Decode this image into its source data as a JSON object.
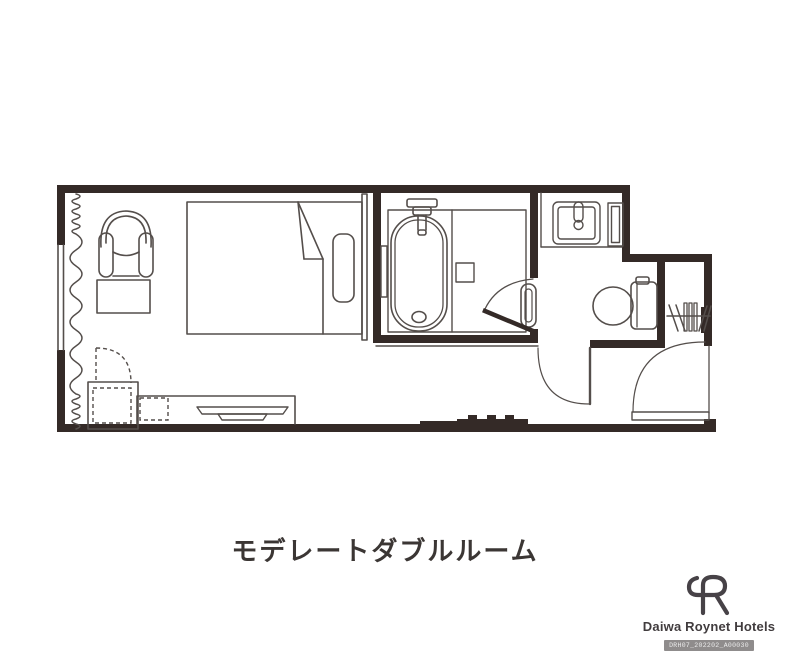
{
  "title": "モデレートダブルルーム",
  "brand": {
    "name": "Daiwa Roynet Hotels",
    "code": "DRH07_202202_A00030"
  },
  "colors": {
    "wall": "#342a27",
    "line": "#544e4b",
    "text": "#3b3634",
    "badge_bg": "#8f8c8c",
    "badge_text": "#ececec"
  },
  "fixtures": {
    "window": "window-with-curtain",
    "curtain": "wavy-curtain-line",
    "armchair": "armchair",
    "side_table": "side-table",
    "bed": "double-bed-with-duvet-fold",
    "pillow": "pillow",
    "headboard": "headboard-panel",
    "closet_door_dashed": "dashed-door-swing",
    "luggage_rack": "luggage-rack",
    "stool": "dashed-stool",
    "desk": "desk-counter",
    "tv": "television",
    "bathtub": "bathtub-with-faucet",
    "bath_shelf": "bath-shelf",
    "towel_bar": "towel-bar",
    "bathroom_door": "bathroom-door-with-handle",
    "washbasin": "washbasin-with-faucet",
    "mirror_cabinet": "mirror-cabinet",
    "toilet": "toilet",
    "toilet_door": "toilet-door-swing",
    "hangers": "closet-hangers",
    "entrance_door": "entrance-door-swing"
  }
}
